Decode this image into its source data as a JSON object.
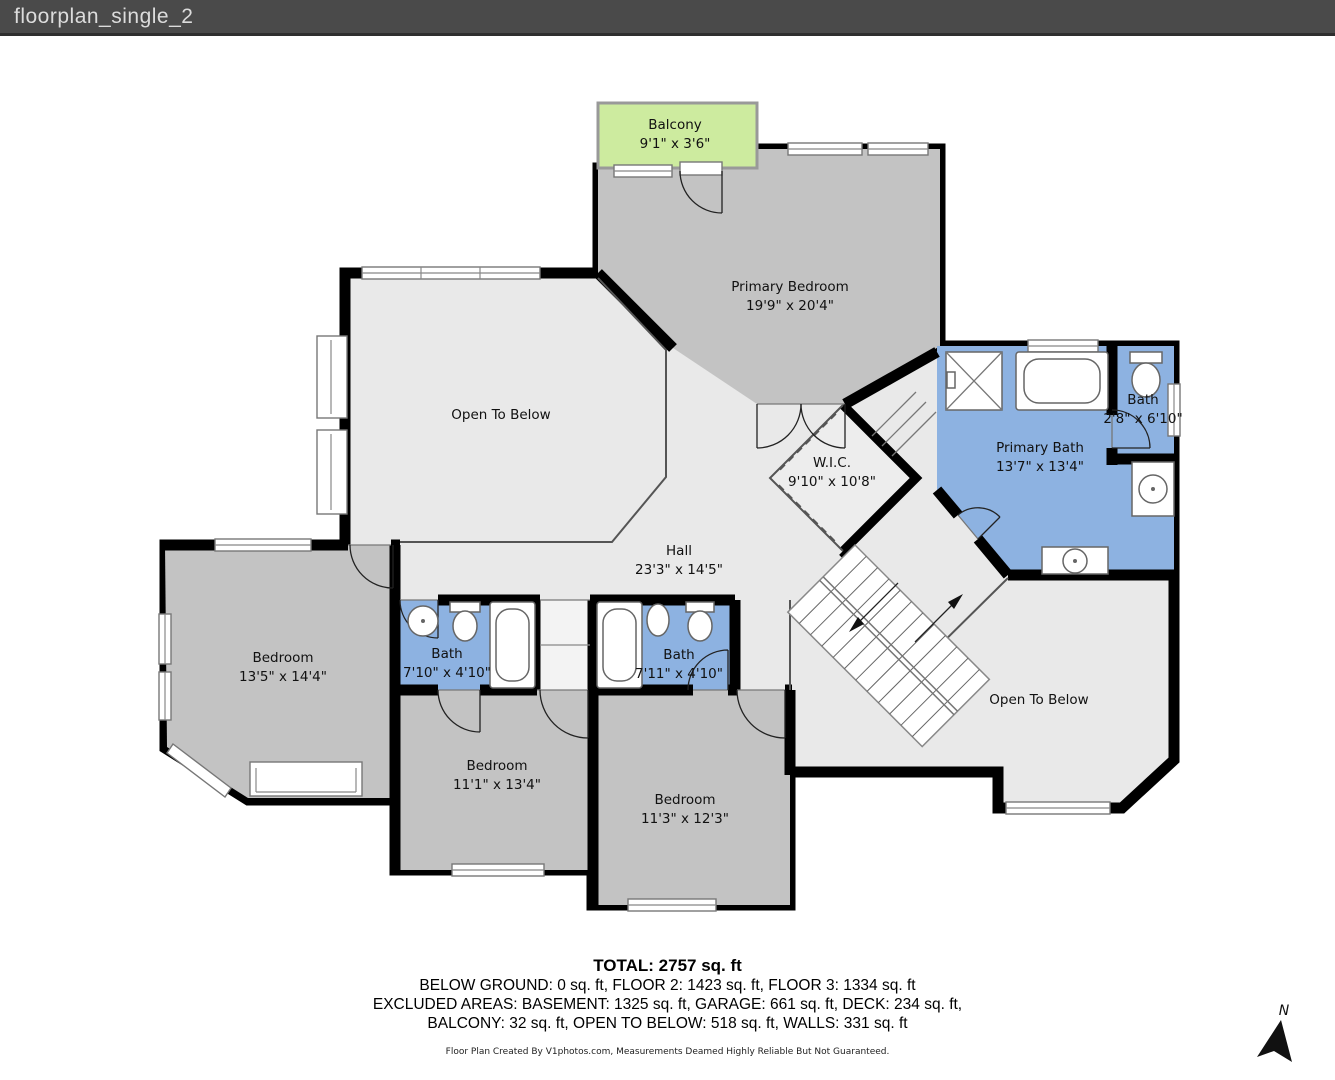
{
  "window": {
    "title": "floorplan_single_2"
  },
  "rooms": {
    "balcony": {
      "name": "Balcony",
      "dims": "9'1\" x 3'6\""
    },
    "primary_bedroom": {
      "name": "Primary Bedroom",
      "dims": "19'9\" x 20'4\""
    },
    "open_to_below_left": {
      "name": "Open To Below"
    },
    "wic": {
      "name": "W.I.C.",
      "dims": "9'10\" x 10'8\""
    },
    "primary_bath": {
      "name": "Primary Bath",
      "dims": "13'7\" x 13'4\""
    },
    "bath_upper_right": {
      "name": "Bath",
      "dims": "2'8\" x 6'10\""
    },
    "hall": {
      "name": "Hall",
      "dims": "23'3\" x 14'5\""
    },
    "bedroom_left": {
      "name": "Bedroom",
      "dims": "13'5\" x 14'4\""
    },
    "bath_left": {
      "name": "Bath",
      "dims": "7'10\" x 4'10\""
    },
    "bath_right": {
      "name": "Bath",
      "dims": "7'11\" x 4'10\""
    },
    "bedroom_middle": {
      "name": "Bedroom",
      "dims": "11'1\" x 13'4\""
    },
    "bedroom_bottom": {
      "name": "Bedroom",
      "dims": "11'3\" x 12'3\""
    },
    "open_to_below_right": {
      "name": "Open To Below"
    }
  },
  "summary": {
    "total": "TOTAL: 2757 sq. ft",
    "floors_line": "BELOW GROUND: 0 sq. ft, FLOOR 2: 1423 sq. ft, FLOOR 3: 1334 sq. ft",
    "excluded_line_1": "EXCLUDED AREAS: BASEMENT: 1325 sq. ft, GARAGE: 661 sq. ft, DECK: 234 sq. ft,",
    "excluded_line_2": "BALCONY: 32 sq. ft, OPEN TO BELOW: 518 sq. ft, WALLS: 331 sq. ft",
    "disclaimer": "Floor Plan Created By V1photos.com, Measurements Deamed Highly Reliable But Not Guaranteed."
  },
  "compass": {
    "label": "N"
  },
  "colors": {
    "wall": "#000000",
    "bedroom_fill": "#c3c3c3",
    "open_area_fill": "#e9e9e9",
    "bath_fill": "#8db2e1",
    "balcony_fill": "#cdeb9f",
    "title_bar": "#4a4a4a"
  }
}
